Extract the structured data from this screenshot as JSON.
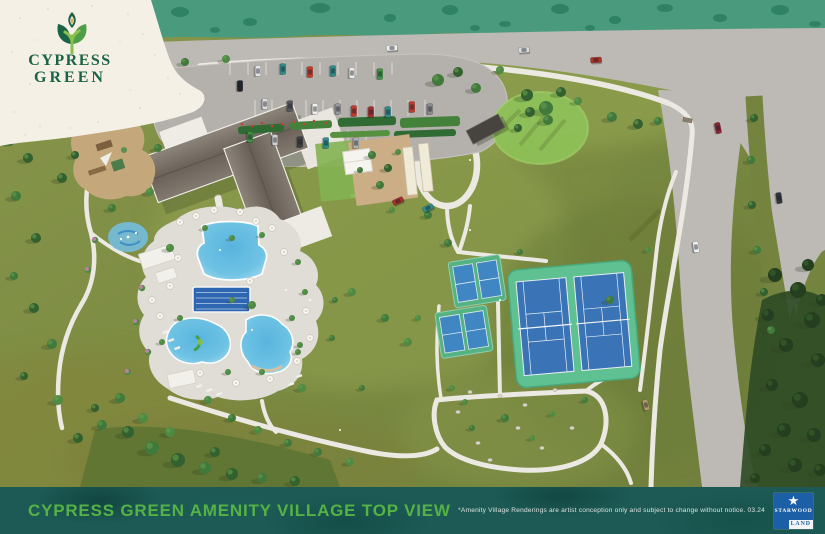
{
  "logo": {
    "line1": "CYPRESS",
    "line2": "GREEN",
    "icon": "cypress-tree-icon"
  },
  "footer": {
    "title": "CYPRESS GREEN AMENITY VILLAGE TOP VIEW",
    "disclaimer": "*Amenity Village Renderings are artist conception only and subject to change without notice. 03.24",
    "publisher": {
      "line1": "STARWOOD",
      "line2": "LAND",
      "icon": "starwood-land-logo",
      "star_icon": "star-icon"
    }
  },
  "colors": {
    "brand_green": "#1a6346",
    "title_green": "#55b245",
    "footer_teal": "#1d5a55",
    "starwood_blue": "#1d5fa7",
    "cream": "#f4f0e6",
    "grass": "#7c8c42",
    "forest_band": "#4a9b7e",
    "road_gray": "#bdb9b5",
    "water_blue": "#58b4de",
    "lap_pool_blue": "#2e66b2",
    "court_blue": "#3a74b6",
    "court_pad_green": "#5fc091"
  }
}
